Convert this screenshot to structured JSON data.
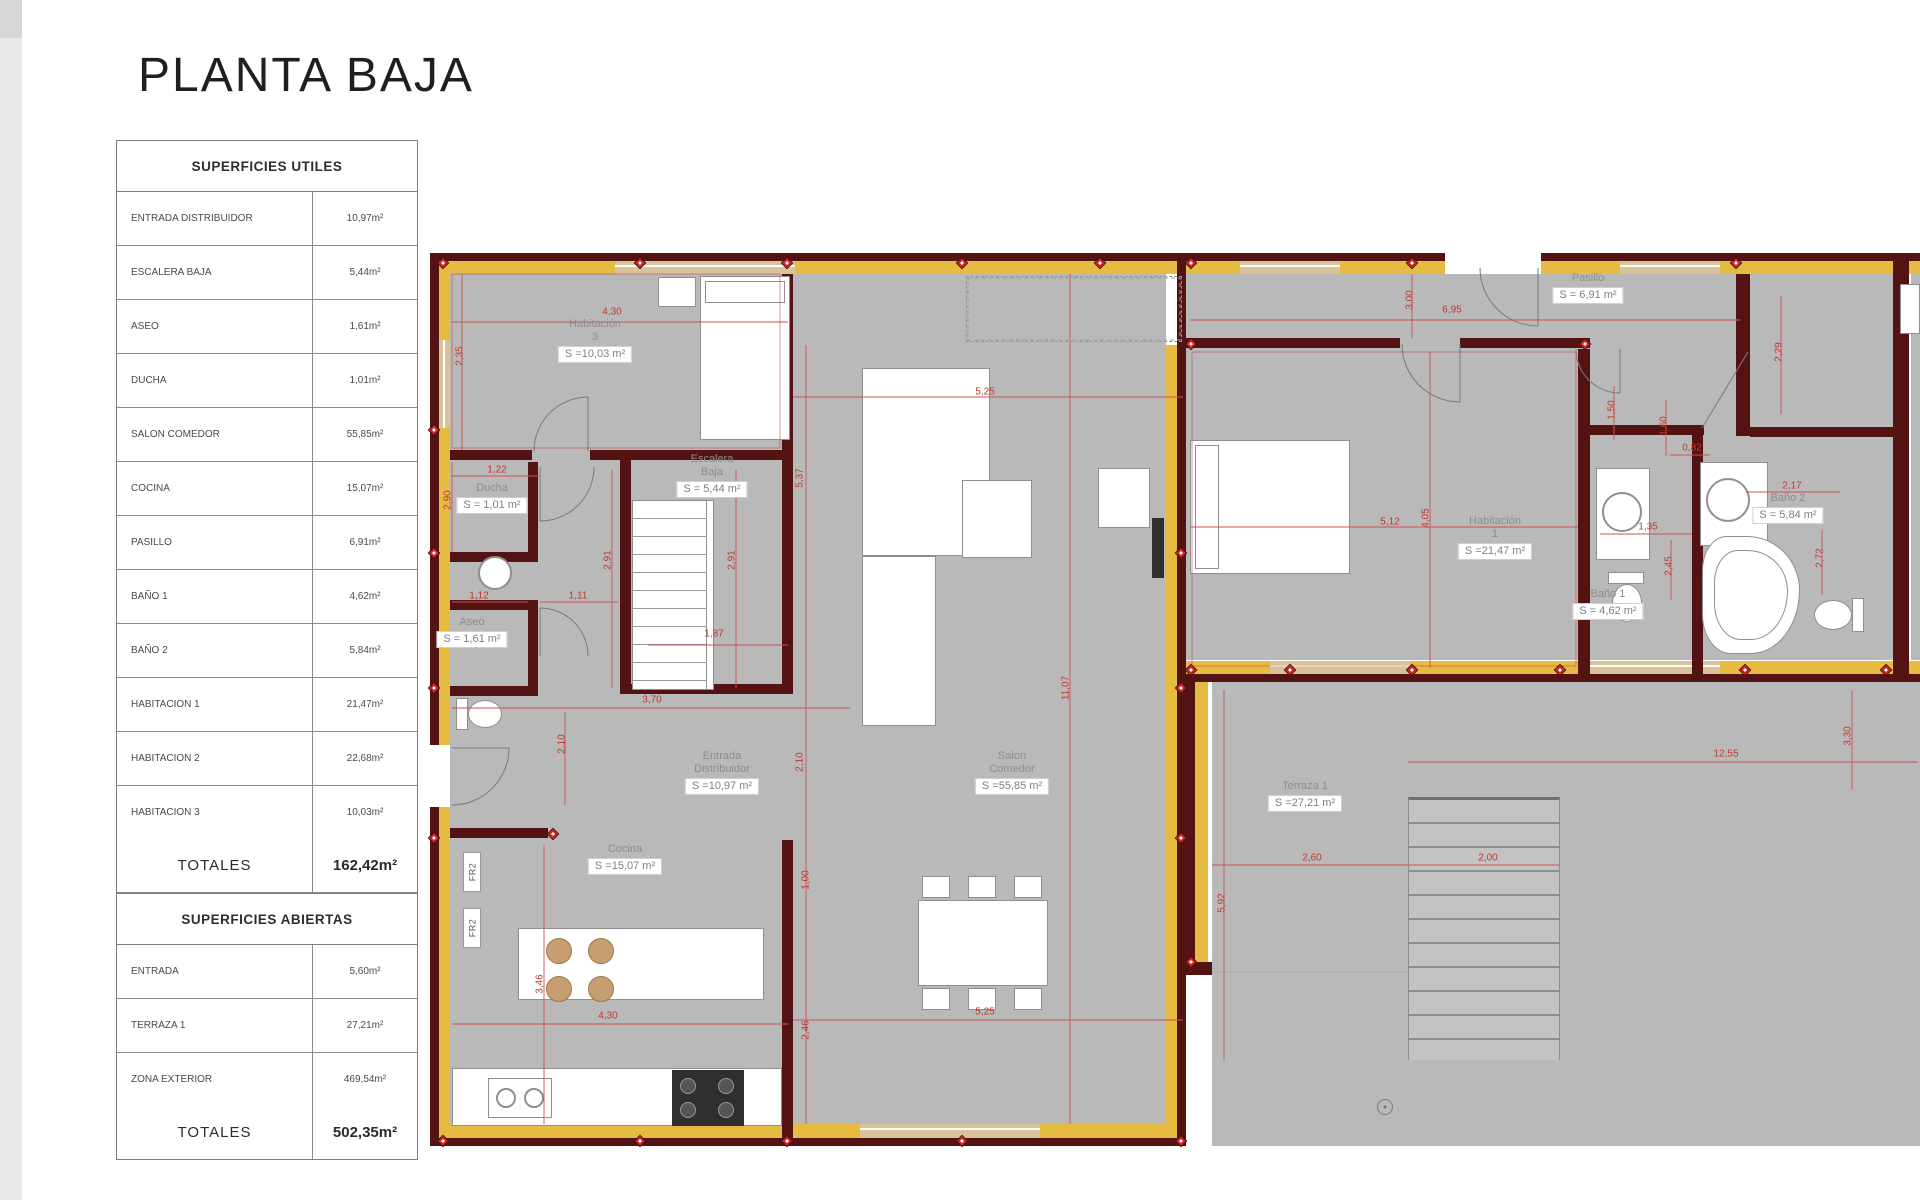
{
  "page": {
    "title": "PLANTA BAJA"
  },
  "table": {
    "header_utiles": "SUPERFICIES UTILES",
    "rows_utiles": [
      {
        "label": "ENTRADA DISTRIBUIDOR",
        "value": "10,97m²"
      },
      {
        "label": "ESCALERA BAJA",
        "value": "5,44m²"
      },
      {
        "label": "ASEO",
        "value": "1,61m²"
      },
      {
        "label": "DUCHA",
        "value": "1,01m²"
      },
      {
        "label": "SALON COMEDOR",
        "value": "55,85m²"
      },
      {
        "label": "COCINA",
        "value": "15,07m²"
      },
      {
        "label": "PASILLO",
        "value": "6,91m²"
      },
      {
        "label": "BAÑO 1",
        "value": "4,62m²"
      },
      {
        "label": "BAÑO 2",
        "value": "5,84m²"
      },
      {
        "label": "HABITACION 1",
        "value": "21,47m²"
      },
      {
        "label": "HABITACION 2",
        "value": "22,68m²"
      },
      {
        "label": "HABITACION 3",
        "value": "10,03m²"
      }
    ],
    "totals_utiles": {
      "label": "TOTALES",
      "value": "162,42m²"
    },
    "header_abiertas": "SUPERFICIES ABIERTAS",
    "rows_abiertas": [
      {
        "label": "ENTRADA",
        "value": "5,60m²"
      },
      {
        "label": "TERRAZA 1",
        "value": "27,21m²"
      },
      {
        "label": "ZONA EXTERIOR",
        "value": "469,54m²"
      }
    ],
    "totals_abiertas": {
      "label": "TOTALES",
      "value": "502,35m²"
    }
  },
  "plan": {
    "room_labels": [
      {
        "name": "habitacion-3",
        "lines": [
          "Habitación",
          "3"
        ],
        "area": "S =10,03 m²",
        "x": 595,
        "y": 318
      },
      {
        "name": "escalera-baja",
        "lines": [
          "Escalera",
          "Baja"
        ],
        "area": "S = 5,44 m²",
        "x": 712,
        "y": 453
      },
      {
        "name": "ducha",
        "lines": [
          "Ducha"
        ],
        "area": "S = 1,01 m²",
        "x": 492,
        "y": 482
      },
      {
        "name": "aseo",
        "lines": [
          "Aseo"
        ],
        "area": "S = 1,61 m²",
        "x": 472,
        "y": 616
      },
      {
        "name": "entrada-distribuidor",
        "lines": [
          "Entrada",
          "Distribuidor"
        ],
        "area": "S =10,97 m²",
        "x": 722,
        "y": 750
      },
      {
        "name": "cocina",
        "lines": [
          "Cocina"
        ],
        "area": "S =15,07 m²",
        "x": 625,
        "y": 843
      },
      {
        "name": "salon-comedor",
        "lines": [
          "Salon",
          "Comedor"
        ],
        "area": "S =55,85 m²",
        "x": 1012,
        "y": 750
      },
      {
        "name": "pasillo",
        "lines": [
          "Pasillo"
        ],
        "area": "S = 6,91 m²",
        "x": 1588,
        "y": 272
      },
      {
        "name": "habitacion-1",
        "lines": [
          "Habitación",
          "1"
        ],
        "area": "S =21,47 m²",
        "x": 1495,
        "y": 515
      },
      {
        "name": "bano-1",
        "lines": [
          "Baño 1"
        ],
        "area": "S = 4,62 m²",
        "x": 1608,
        "y": 588
      },
      {
        "name": "bano-2",
        "lines": [
          "Baño 2"
        ],
        "area": "S = 5,84 m²",
        "x": 1788,
        "y": 492
      },
      {
        "name": "terraza-1",
        "lines": [
          "Terraza 1"
        ],
        "area": "S =27,21 m²",
        "x": 1305,
        "y": 780
      }
    ],
    "dims": [
      {
        "t": "4,30",
        "x": 612,
        "y": 312
      },
      {
        "t": "2,35",
        "x": 460,
        "y": 356,
        "v": true
      },
      {
        "t": "1,22",
        "x": 497,
        "y": 470
      },
      {
        "t": "2,90",
        "x": 448,
        "y": 500,
        "v": true
      },
      {
        "t": "1,12",
        "x": 479,
        "y": 596
      },
      {
        "t": "1,11",
        "x": 578,
        "y": 596
      },
      {
        "t": "2,91",
        "x": 608,
        "y": 560,
        "v": true
      },
      {
        "t": "2,91",
        "x": 732,
        "y": 560,
        "v": true
      },
      {
        "t": "1,87",
        "x": 714,
        "y": 634
      },
      {
        "t": "3,70",
        "x": 652,
        "y": 700
      },
      {
        "t": "2,10",
        "x": 562,
        "y": 744,
        "v": true
      },
      {
        "t": "2,10",
        "x": 800,
        "y": 762,
        "v": true
      },
      {
        "t": "5,37",
        "x": 800,
        "y": 478,
        "v": true
      },
      {
        "t": "5,25",
        "x": 985,
        "y": 392
      },
      {
        "t": "11,07",
        "x": 1066,
        "y": 688,
        "v": true
      },
      {
        "t": "1,00",
        "x": 806,
        "y": 880,
        "v": true
      },
      {
        "t": "2,46",
        "x": 806,
        "y": 1030,
        "v": true
      },
      {
        "t": "3,46",
        "x": 540,
        "y": 984,
        "v": true
      },
      {
        "t": "4,30",
        "x": 608,
        "y": 1016
      },
      {
        "t": "5,25",
        "x": 985,
        "y": 1012
      },
      {
        "t": "3,00",
        "x": 1410,
        "y": 300,
        "v": true
      },
      {
        "t": "6,95",
        "x": 1452,
        "y": 310
      },
      {
        "t": "2,29",
        "x": 1779,
        "y": 352,
        "v": true
      },
      {
        "t": "1,50",
        "x": 1612,
        "y": 410,
        "v": true
      },
      {
        "t": "1,60",
        "x": 1664,
        "y": 426,
        "v": true
      },
      {
        "t": "0,82",
        "x": 1692,
        "y": 448
      },
      {
        "t": "2,17",
        "x": 1792,
        "y": 486
      },
      {
        "t": "1,35",
        "x": 1648,
        "y": 527
      },
      {
        "t": "2,45",
        "x": 1669,
        "y": 566,
        "v": true
      },
      {
        "t": "2,72",
        "x": 1820,
        "y": 558,
        "v": true
      },
      {
        "t": "5,12",
        "x": 1390,
        "y": 522
      },
      {
        "t": "4,05",
        "x": 1426,
        "y": 518,
        "v": true
      },
      {
        "t": "12,55",
        "x": 1726,
        "y": 754
      },
      {
        "t": "3,30",
        "x": 1848,
        "y": 736,
        "v": true
      },
      {
        "t": "2,60",
        "x": 1312,
        "y": 858
      },
      {
        "t": "2,00",
        "x": 1488,
        "y": 858
      },
      {
        "t": "5,92",
        "x": 1222,
        "y": 903,
        "v": true
      }
    ],
    "fr_labels": [
      {
        "t": "FR2",
        "x": 463,
        "y": 852
      },
      {
        "t": "FR2",
        "x": 463,
        "y": 908
      }
    ]
  },
  "colors": {
    "wall": "#541313",
    "gold": "#e5bb41",
    "window_tan": "#d8c498",
    "floor": "#b9b9b9",
    "dimension_red": "#c0392b"
  }
}
